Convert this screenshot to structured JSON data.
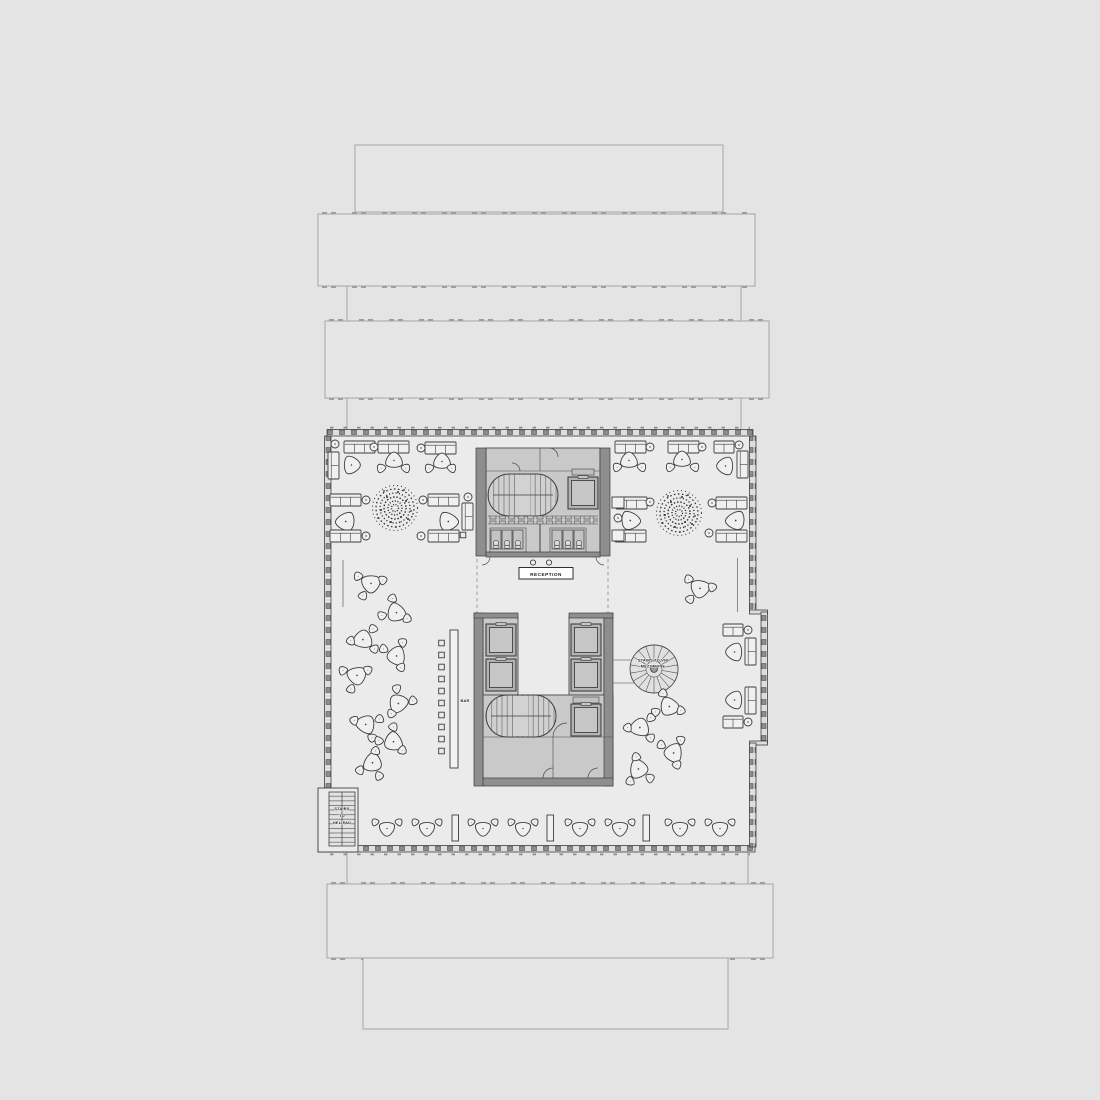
{
  "page": {
    "width": 1100,
    "height": 1100,
    "background": "#e4e4e5"
  },
  "floor_plan": {
    "type": "architectural-floor-plan",
    "labels": {
      "reception": "RECEPTION",
      "bar": "BAR",
      "vip_stairs_line1": "STAIRS TO VIP",
      "vip_stairs_line2": "MEZZANINE",
      "helipad_stairs_line1": "STAIRS",
      "helipad_stairs_line2": "TO",
      "helipad_stairs_line3": "HELIPAD"
    },
    "colors": {
      "background": "#e4e4e5",
      "floor_fill": "#ebebeb",
      "core_fill": "#c9c9c9",
      "core_wall_fill": "#8e8e8e",
      "furniture_fill": "#f0f0f0",
      "line_dark": "#3d3d3d",
      "ghost_outline": "#9e9e9e"
    },
    "symbols": [
      "tree-icon",
      "lounge-chair-icon",
      "small-chair-icon",
      "sofa-icon",
      "couch-icon",
      "round-table-icon",
      "bar-stool-icon",
      "bench-icon",
      "elevator-icon",
      "switchback-stair-icon",
      "spiral-stair-icon",
      "wc-stall-icon"
    ]
  }
}
